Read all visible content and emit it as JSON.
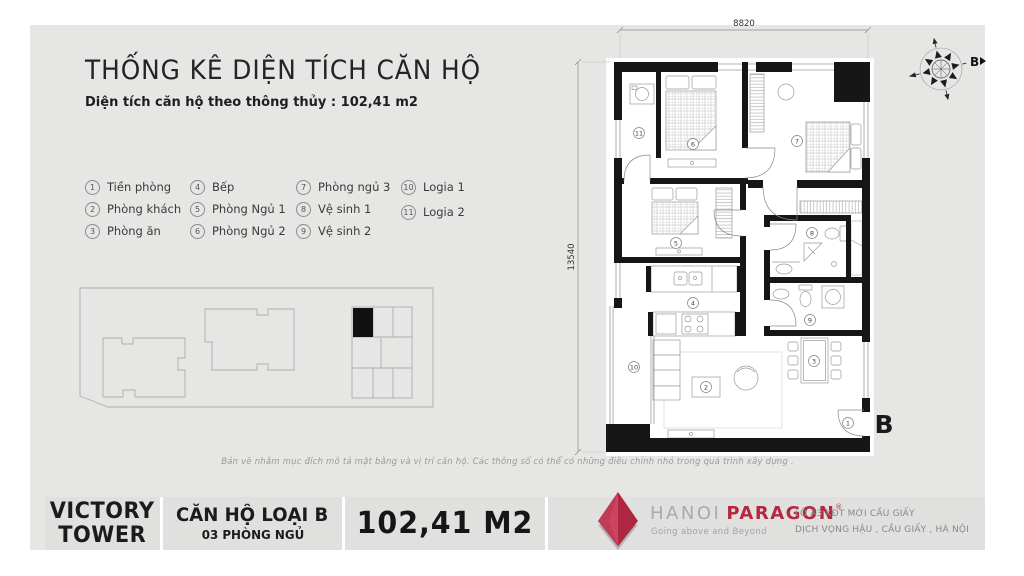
{
  "header": {
    "title": "THỐNG KÊ DIỆN TÍCH CĂN HỘ",
    "subtitle": "Diện tích căn hộ theo thông thủy : 102,41 m2"
  },
  "legend": {
    "items": [
      {
        "num": "1",
        "label": "Tiền phòng"
      },
      {
        "num": "2",
        "label": "Phòng khách"
      },
      {
        "num": "3",
        "label": "Phòng ăn"
      },
      {
        "num": "4",
        "label": "Bếp"
      },
      {
        "num": "5",
        "label": "Phòng Ngủ 1"
      },
      {
        "num": "6",
        "label": "Phòng Ngủ 2"
      },
      {
        "num": "7",
        "label": "Phòng ngủ 3"
      },
      {
        "num": "8",
        "label": "Vệ sinh 1"
      },
      {
        "num": "9",
        "label": "Vệ sinh 2"
      },
      {
        "num": "10",
        "label": "Logia 1"
      },
      {
        "num": "11",
        "label": "Logia 2"
      }
    ]
  },
  "plan": {
    "dim_top": "8820",
    "dim_left": "13540",
    "entry_label": "B",
    "compass_label": "B"
  },
  "disclaimer": "Bản vẽ nhằm mục đích mô tả mặt bằng và vị trí căn hộ. Các thông số có thể có những điều chỉnh nhỏ trong quá trình xây dựng .",
  "footer": {
    "tower_line1": "VICTORY",
    "tower_line2": "TOWER",
    "unit_type": "CĂN HỘ LOẠI B",
    "unit_bedrooms": "03 PHÒNG NGỦ",
    "area": "102,41 M2",
    "brand_gray": "HANOI",
    "brand_red": "PARAGON",
    "brand_reg": "®",
    "brand_tagline": "Going above and Beyond",
    "address_line1": "LÔ A3 KĐT MỚI CẦU GIẤY",
    "address_line2": "DỊCH VỌNG HẬU , CẦU GIẤY , HÀ NỘI"
  },
  "colors": {
    "brand_red": "#b5283f",
    "card_bg": "#e6e6e4"
  }
}
